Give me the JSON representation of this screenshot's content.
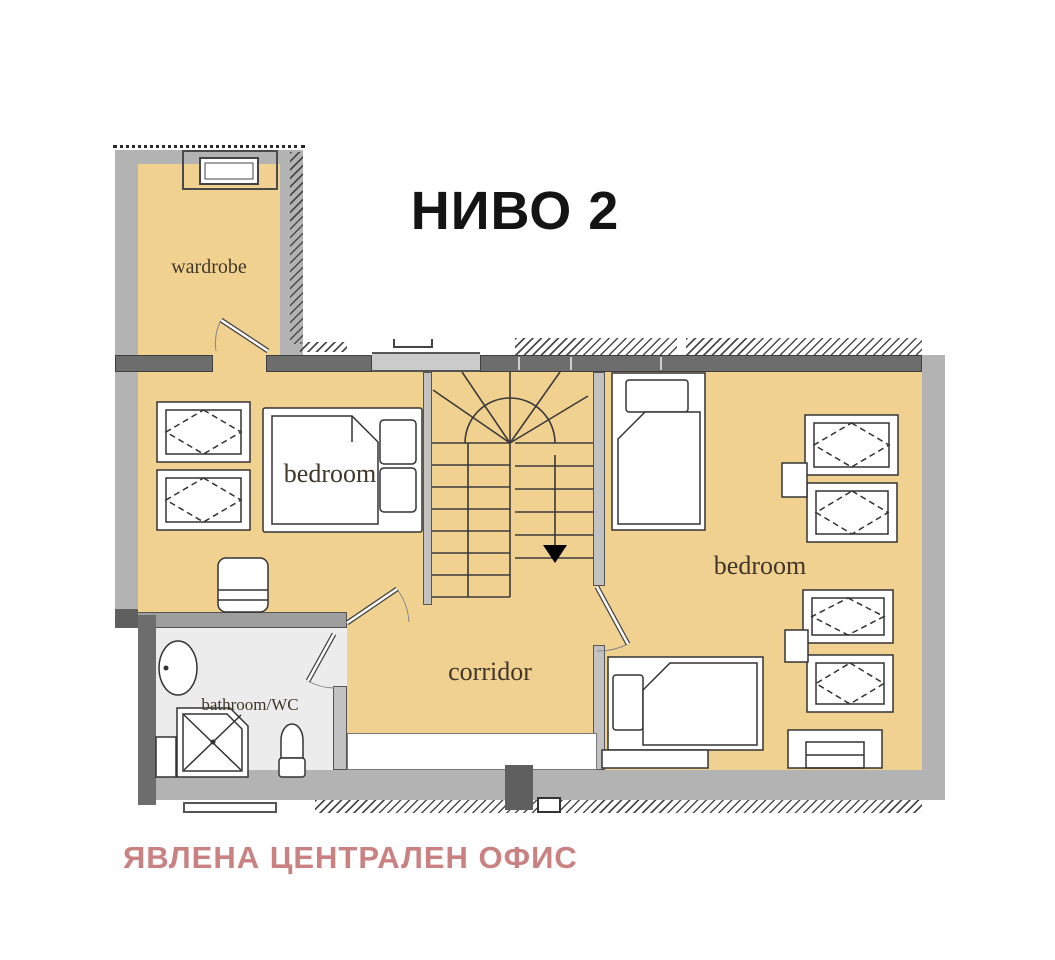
{
  "title": "НИВО 2",
  "watermark": "ЯВЛЕНА ЦЕНТРАЛЕН ОФИС",
  "rooms": {
    "wardrobe": {
      "label": "wardrobe"
    },
    "bedroom_left": {
      "label": "bedroom"
    },
    "bedroom_right": {
      "label": "bedroom"
    },
    "corridor": {
      "label": "corridor"
    },
    "bathroom": {
      "label": "bathroom/WC"
    }
  },
  "stairs": {
    "direction": "down"
  },
  "colors": {
    "floor_tan": "#f1d190",
    "wall_gray": "#b3b3b3",
    "wall_dark": "#6d6d6d",
    "bathroom_floor": "#ececec",
    "line": "#333333",
    "title_color": "#141414",
    "watermark_color": "#c98181"
  }
}
